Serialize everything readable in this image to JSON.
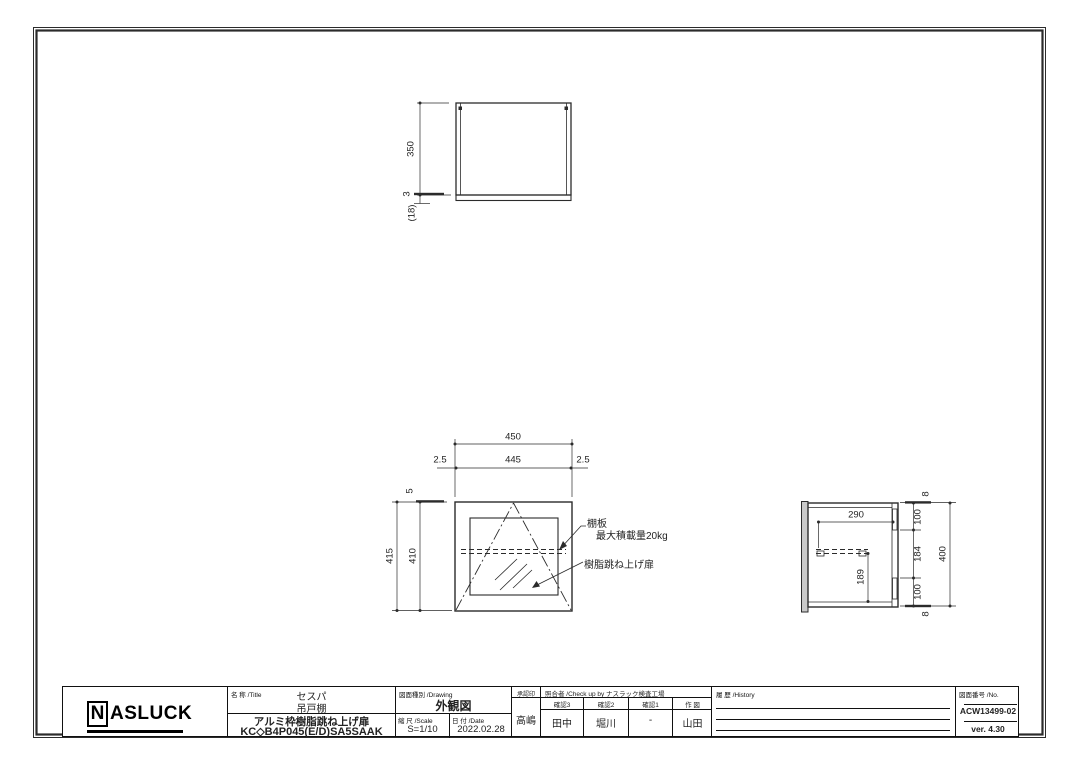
{
  "colors": {
    "line": "#2b2b2b",
    "background": "#ffffff"
  },
  "views": {
    "top_view": {
      "dim_depth": "350",
      "dim_gap": "3",
      "dim_door_thickness": "(18)"
    },
    "front_view": {
      "dim_width_overall": "450",
      "dim_width_inner": "445",
      "dim_edge_left": "2.5",
      "dim_edge_right": "2.5",
      "dim_height_overall": "415",
      "dim_height_body": "410",
      "dim_top_gap": "5",
      "note_shelf": "棚板",
      "note_shelf_load": "最大積載量20kg",
      "note_door": "樹脂跳ね上げ扉"
    },
    "side_view": {
      "dim_inner_depth": "290",
      "dim_shelf_height": "189",
      "dim_seg_top": "8",
      "dim_seg_upper": "100",
      "dim_seg_middle": "184",
      "dim_seg_lower": "100",
      "dim_seg_bottom": "8",
      "dim_height_overall": "400"
    }
  },
  "title_block": {
    "logo_initial": "N",
    "logo_rest": "ASLUCK",
    "name_label": "名 称 /Title",
    "product_series": "セスパ",
    "product_category": "吊戸棚",
    "product_description": "アルミ枠樹脂跳ね上げ扉",
    "product_code": "KC◇B4P045(E/D)SA5SAAK",
    "drawing_label": "図面種別 /Drawing",
    "drawing_type": "外観図",
    "scale_label": "縮 尺 /Scale",
    "scale_value": "S=1/10",
    "date_label": "日 付 /Date",
    "date_value": "2022.02.28",
    "approval_label": "承認印",
    "approval_value": "高嶋",
    "check_label": "照合者 /Check up by ナスラック検査工場",
    "check_columns": [
      {
        "label": "確認3",
        "value": "田中"
      },
      {
        "label": "確認2",
        "value": "堀川"
      },
      {
        "label": "確認1",
        "value": "-"
      },
      {
        "label": "作 図",
        "value": "山田"
      }
    ],
    "history_label": "履 歴 /History",
    "number_label": "図面番号 /No.",
    "drawing_number": "ACW13499-02",
    "version": "ver. 4.30"
  }
}
